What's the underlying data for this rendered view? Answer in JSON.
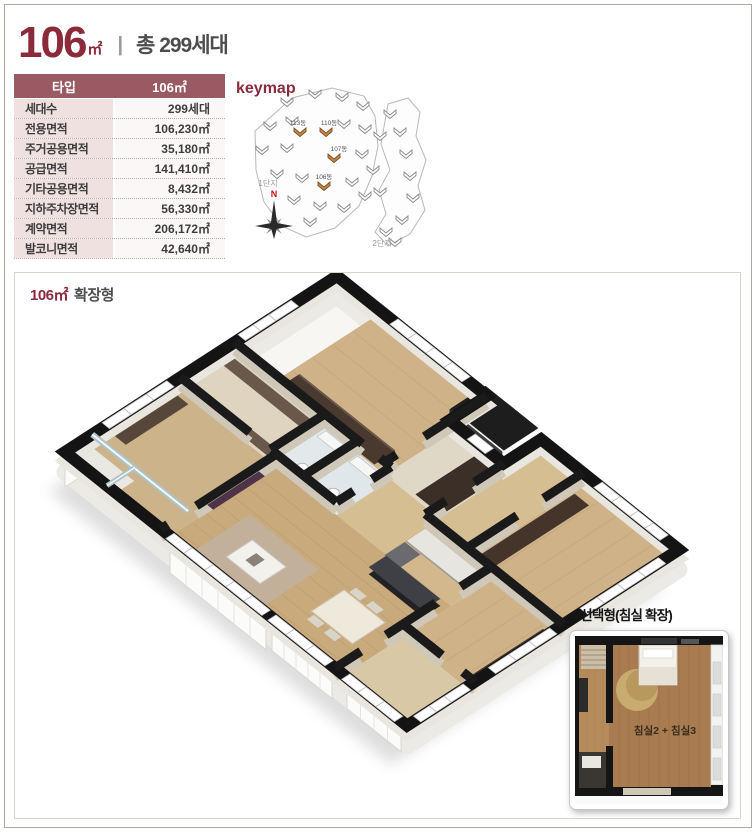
{
  "header": {
    "size": "106",
    "unit": "㎡",
    "separator": "|",
    "total": "총 299세대"
  },
  "spec_table": {
    "header": {
      "label": "타입",
      "value": "106㎡"
    },
    "rows": [
      {
        "label": "세대수",
        "value": "299세대"
      },
      {
        "label": "전용면적",
        "value": "106,230㎡"
      },
      {
        "label": "주거공용면적",
        "value": "35,180㎡"
      },
      {
        "label": "공급면적",
        "value": "141,410㎡"
      },
      {
        "label": "기타공용면적",
        "value": "8,432㎡"
      },
      {
        "label": "지하주차장면적",
        "value": "56,330㎡"
      },
      {
        "label": "계약면적",
        "value": "206,172㎡"
      },
      {
        "label": "발코니면적",
        "value": "42,640㎡"
      }
    ]
  },
  "keymap": {
    "title": "keymap",
    "compass_label": "N",
    "areas": [
      "1단지",
      "2단지"
    ],
    "buildings": [
      {
        "label": "113동"
      },
      {
        "label": "110동"
      },
      {
        "label": "107동"
      },
      {
        "label": "106동"
      }
    ]
  },
  "floorplan": {
    "title_size": "106㎡",
    "title_type": "확장형"
  },
  "inset": {
    "title": "■ 선택형(침실 확장)",
    "room_label": "침실2 + 침실3"
  },
  "colors": {
    "accent": "#8b2a3b",
    "table_header_bg": "#9a5a64",
    "label_bg": "#f0e1e1",
    "value_bg": "#fbf7f7",
    "highlight_building": "#c8864a"
  }
}
